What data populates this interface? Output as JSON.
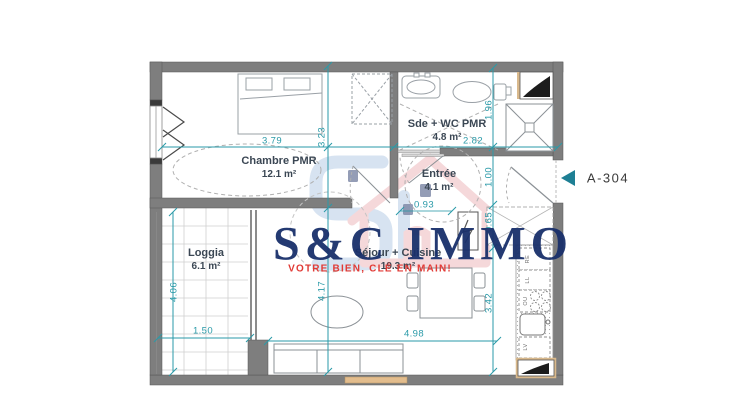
{
  "plan": {
    "unit_label": "A-304",
    "rooms": {
      "chambre": {
        "name": "Chambre PMR",
        "area": "12.1 m²"
      },
      "sde": {
        "name": "Sde + WC PMR",
        "area": "4.8 m²"
      },
      "entree": {
        "name": "Entrée",
        "area": "4.1 m²"
      },
      "sejour": {
        "name": "Séjour + Cuisine",
        "area": "19.3 m²"
      },
      "loggia": {
        "name": "Loggia",
        "area": "6.1 m²"
      }
    },
    "dimensions": {
      "chambre_w": "3.79",
      "chambre_h": "3.23",
      "sde_w": "2.82",
      "sde_h": "1.96",
      "door_h": "1.00",
      "entree_w": "0.93",
      "closet_h": "0.65",
      "kitchen_h": "3.42",
      "sejour_h": "4.17",
      "sejour_w": "4.98",
      "loggia_w": "1.50",
      "loggia_h": "4.06"
    },
    "appliance_labels": {
      "fridge": "RE",
      "washer": "LL",
      "oven": "OU",
      "dishwasher": "LV"
    }
  },
  "watermark": {
    "brand": "S&C IMMO",
    "tagline": "VOTRE BIEN, CLÉ EN MAIN!"
  },
  "colors": {
    "dimension_teal": "#2a9aa8",
    "wall_gray": "#7e7e7e",
    "brand_navy": "#19306b",
    "tagline_red": "#e13a35",
    "door_arrow_teal": "#1e7f94",
    "window_tan": "#e3bd8d",
    "logo_blue": "#b7cde6",
    "logo_pink": "#eeb9bd"
  }
}
